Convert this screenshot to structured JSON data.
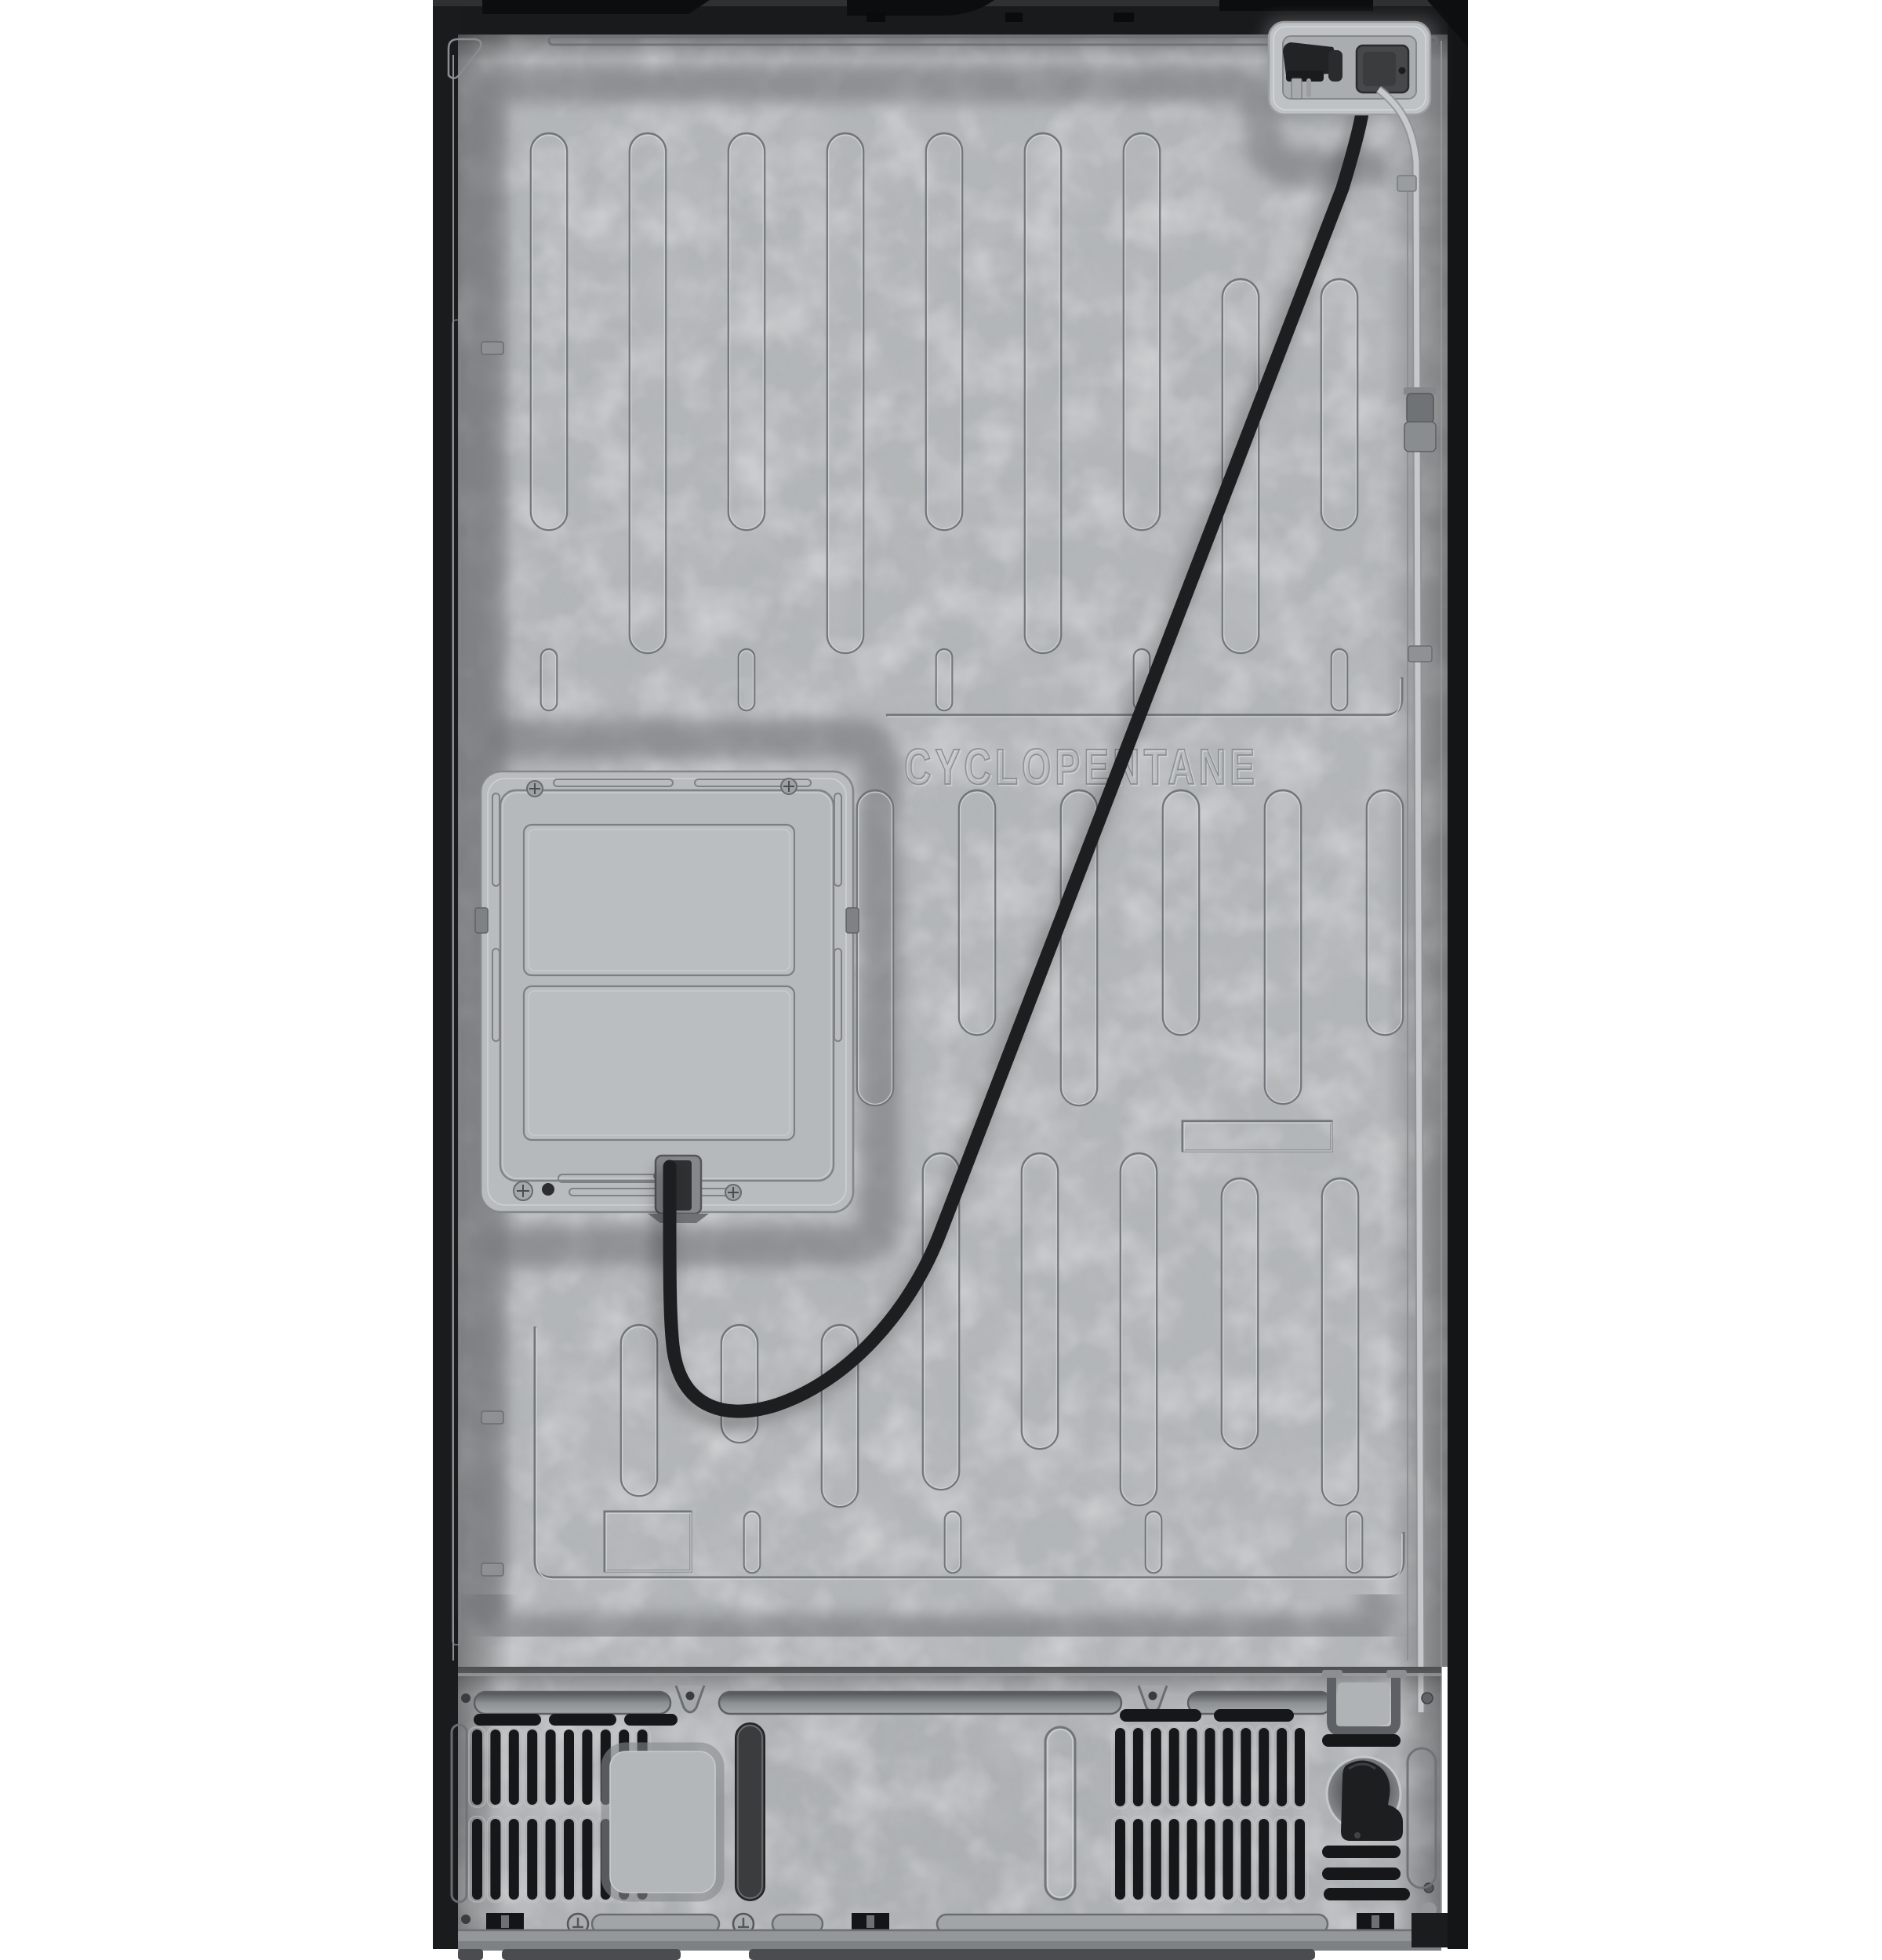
{
  "image": {
    "kind": "product-photo",
    "subject": "refrigerator rear view (back panel)",
    "background_color": "#ffffff"
  },
  "panel": {
    "embossed_text": "CYCLOPENTANE",
    "colors": {
      "galvanized_base": "#b2b5b7",
      "galvanized_light": "#ccced0",
      "recess_shadow": "#6f7276",
      "trim_black": "#1b1c1d",
      "cord_black": "#1d1e1f",
      "water_line_gray": "#c6c9ca",
      "vent_slot_black": "#161718"
    }
  },
  "parts": {
    "top_trim": "top-trim-and-hinge-covers",
    "cord_connector": "power-cord-connector-recess",
    "power_cord": "power-cord",
    "stored_plug": "power-plug-stored-in-recess",
    "water_line": "water-supply-line",
    "water_coupling": "water-line-coupling",
    "access_panel": "rear-access-panel",
    "machine_compartment": "machine-compartment",
    "vent_left": "left-vent-grille",
    "vent_right": "right-vent-grille",
    "center_plate": "drain-pan-cover-plate",
    "ground_symbol": "grounding-symbol"
  }
}
